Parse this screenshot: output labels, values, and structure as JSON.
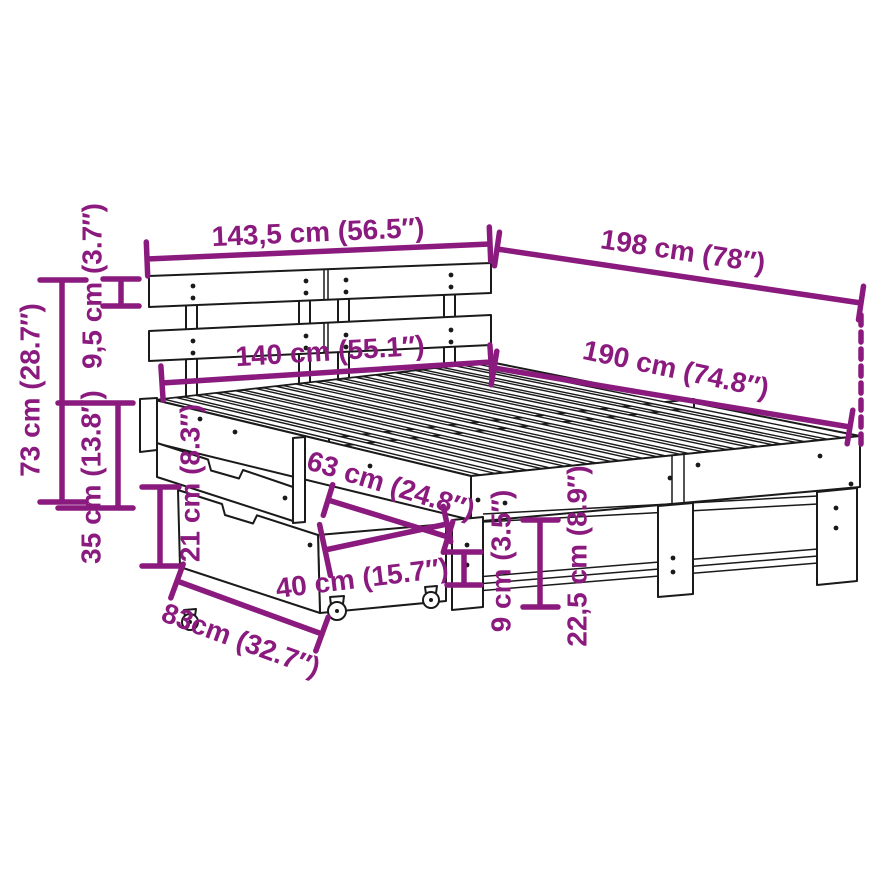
{
  "diagram": {
    "kind": "furniture-dimension-diagram",
    "subject": "bed frame with headboard and two storage drawers",
    "background": "#ffffff",
    "accent_color": "#8b1a7e",
    "line_color": "#1a1a1a",
    "units": "cm / inches",
    "dims": [
      {
        "id": "headboard-width",
        "label": "143,5 cm (56.5″)"
      },
      {
        "id": "total-length",
        "label": "198 cm (78″)"
      },
      {
        "id": "headboard-plank-height",
        "label": "9,5 cm (3.7″)"
      },
      {
        "id": "headboard-height",
        "label": "73 cm (28.7″)"
      },
      {
        "id": "underbed-clearance",
        "label": "35 cm (13.8″)"
      },
      {
        "id": "drawer-front-height",
        "label": "21 cm (8.3″)"
      },
      {
        "id": "drawer-depth",
        "label": "63 cm (24.8″)"
      },
      {
        "id": "drawer-width",
        "label": "40 cm (15.7″)"
      },
      {
        "id": "drawer-length",
        "label": "83cm (32.7″)"
      },
      {
        "id": "side-rail-height",
        "label": "9 cm (3.5″)"
      },
      {
        "id": "frame-height",
        "label": "22,5 cm (8.9″)"
      },
      {
        "id": "mattress-width",
        "label": "140 cm (55.1″)"
      },
      {
        "id": "mattress-length",
        "label": "190 cm (74.8″)"
      }
    ]
  }
}
